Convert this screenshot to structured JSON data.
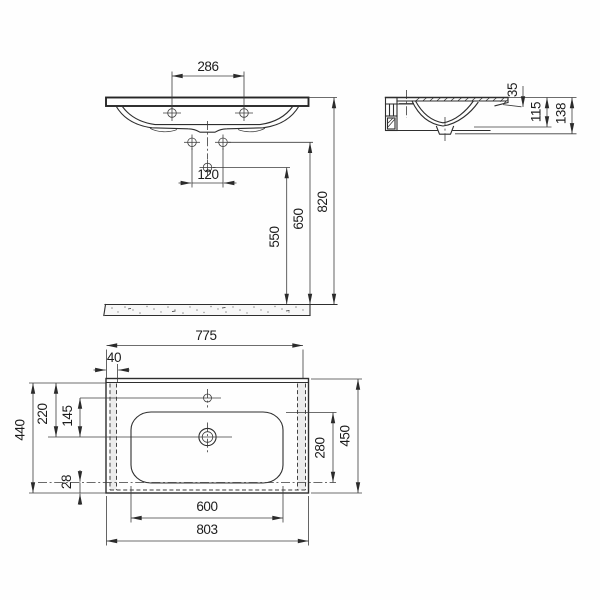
{
  "drawing": {
    "front": {
      "tap_hole_spacing": "286",
      "fixing_hole_spacing": "120",
      "siphon_hole_height": "550",
      "fixing_hole_height": "650",
      "rim_height": "820"
    },
    "side": {
      "rim_thickness": "35",
      "front_apron_depth": "115",
      "total_depth": "138"
    },
    "plan": {
      "back_edge_width": "775",
      "side_offset": "40",
      "drain_from_back": "220",
      "tap_to_drain": "145",
      "inner_depth": "440",
      "front_lip": "28",
      "bowl_depth": "280",
      "overall_depth": "450",
      "bowl_width": "600",
      "overall_width": "803"
    }
  }
}
